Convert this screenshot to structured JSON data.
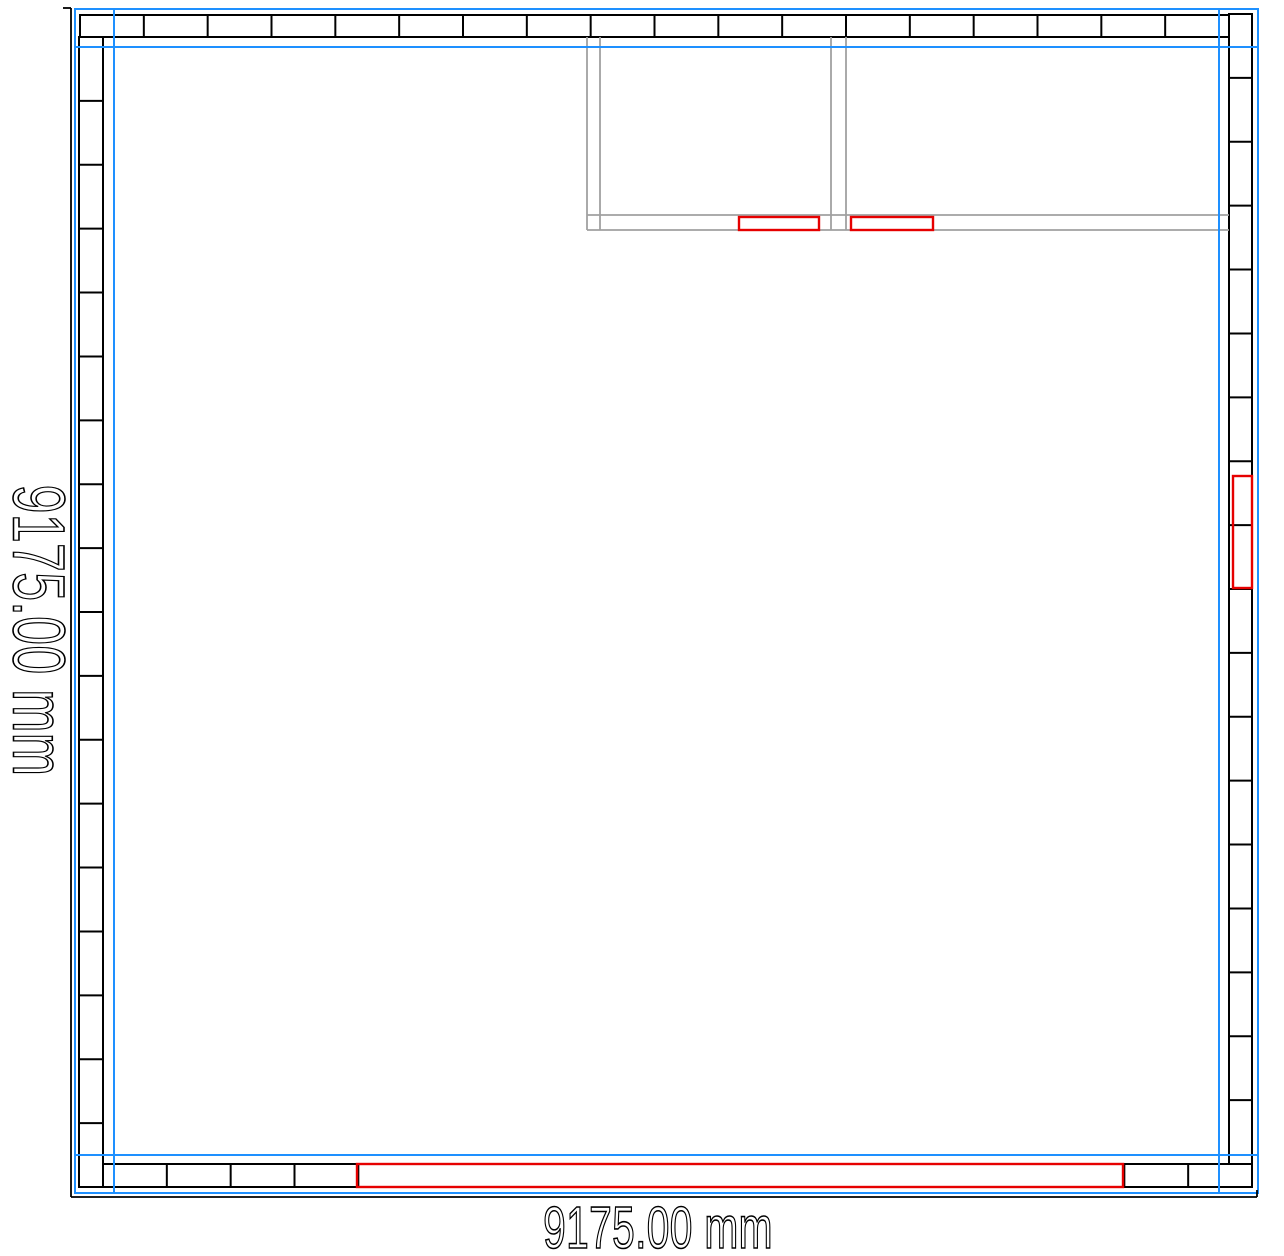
{
  "dimension_labels": {
    "left": "9175.00 mm",
    "bottom": "9175.00 mm"
  },
  "colors": {
    "guide_blue": "#1e90ff",
    "wall_black": "#000000",
    "partition_gray": "#a0a0a0",
    "marker_red": "#e60000",
    "background": "#ffffff"
  },
  "drawing": {
    "canvas": {
      "width": 1284,
      "height": 1256
    },
    "wall_bands": [
      {
        "id": "wall-top",
        "orientation": "horizontal",
        "x": 80,
        "y": 15,
        "length": 1149,
        "thickness": 22,
        "panels": 18
      },
      {
        "id": "wall-left",
        "orientation": "vertical",
        "x": 79,
        "y": 37,
        "length": 1150,
        "thickness": 24,
        "panels": 18
      },
      {
        "id": "wall-right",
        "orientation": "vertical",
        "x": 1229,
        "y": 14,
        "length": 1150,
        "thickness": 23,
        "panels": 18
      },
      {
        "id": "wall-bottom",
        "orientation": "horizontal",
        "x": 103,
        "y": 1164,
        "length": 1149,
        "thickness": 23,
        "panels": 18,
        "divider_gap": [
          362,
          1122
        ]
      }
    ],
    "partition_walls": {
      "stroke_width": 1.8,
      "vertical_lines": [
        {
          "x": 587,
          "y1": 37,
          "y2": 230
        },
        {
          "x": 600,
          "y1": 37,
          "y2": 230
        },
        {
          "x": 831,
          "y1": 37,
          "y2": 230
        },
        {
          "x": 846,
          "y1": 37,
          "y2": 230
        }
      ],
      "horizontal_lines": [
        {
          "y": 215,
          "x1": 587,
          "x2": 1229
        },
        {
          "y": 230,
          "x1": 587,
          "x2": 1229
        }
      ]
    },
    "opening_markers": {
      "stroke_width": 2.4,
      "rects": [
        {
          "id": "marker-room1-door",
          "x": 739,
          "y": 217,
          "width": 80,
          "height": 13
        },
        {
          "id": "marker-room2-door",
          "x": 851,
          "y": 217,
          "width": 82,
          "height": 13
        },
        {
          "id": "marker-right-wall",
          "x": 1233,
          "y": 476,
          "width": 19,
          "height": 112
        },
        {
          "id": "marker-bottom-wall",
          "x": 357,
          "y": 1164,
          "width": 766,
          "height": 23
        }
      ]
    },
    "guide_frame": {
      "stroke_width": 2,
      "outer": {
        "x1": 75,
        "y1": 9,
        "x2": 1258,
        "y2": 1193
      },
      "vertical_guides": [
        114,
        1219
      ],
      "horizontal_guides": [
        47,
        1155
      ]
    },
    "dimension_lines": {
      "stroke_width": 1.8,
      "vertical": {
        "x": 71,
        "y1": 8,
        "y2": 1197
      },
      "horizontal": {
        "y": 1197,
        "x1": 71,
        "x2": 1257
      },
      "ticks": [
        {
          "x1": 63,
          "y1": 8,
          "x2": 71,
          "y2": 8
        },
        {
          "x1": 1257,
          "y1": 1197,
          "x2": 1257,
          "y2": 1190
        }
      ]
    }
  }
}
